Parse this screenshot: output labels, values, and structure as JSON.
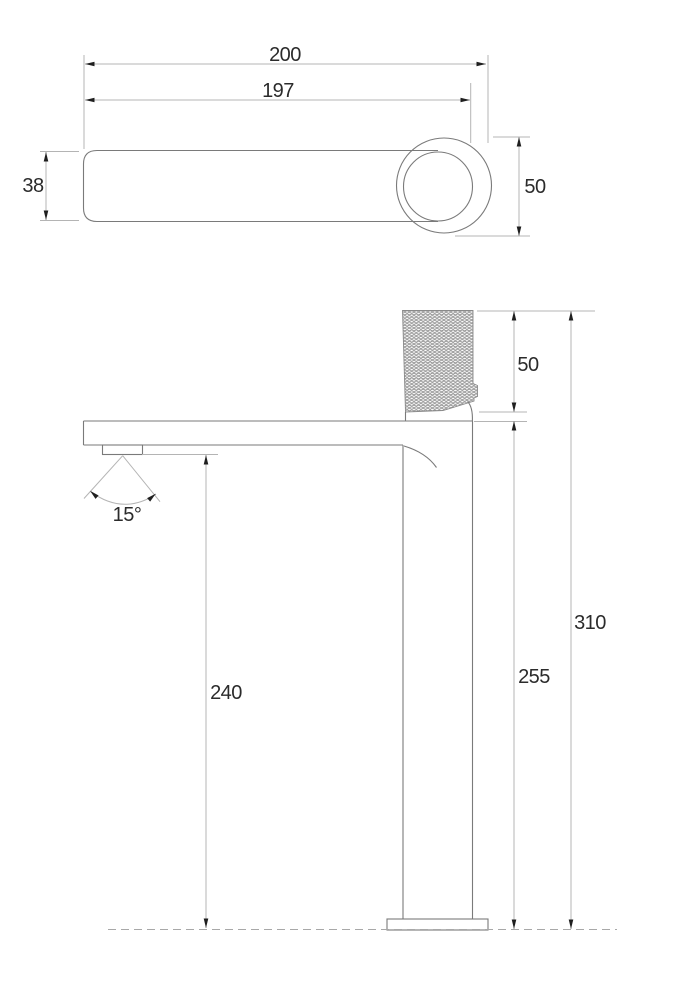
{
  "style": {
    "background": "#ffffff",
    "object_line_color": "#7a7a7a",
    "dimension_line_color": "#b4b4b4",
    "ground_line_color": "#a8a8a8",
    "arrow_color": "#1f1f1f",
    "text_color": "#2b2b2b",
    "knurl_color": "#8a8a8a"
  },
  "top_view": {
    "dim_overall_length": "200",
    "dim_spout_length": "197",
    "dim_spout_width": "38",
    "dim_handle_diameter": "50"
  },
  "side_view": {
    "dim_handle_height": "50",
    "dim_total_height": "310",
    "dim_spout_height": "255",
    "dim_aerator_height": "240",
    "dim_spray_angle": "15°"
  }
}
